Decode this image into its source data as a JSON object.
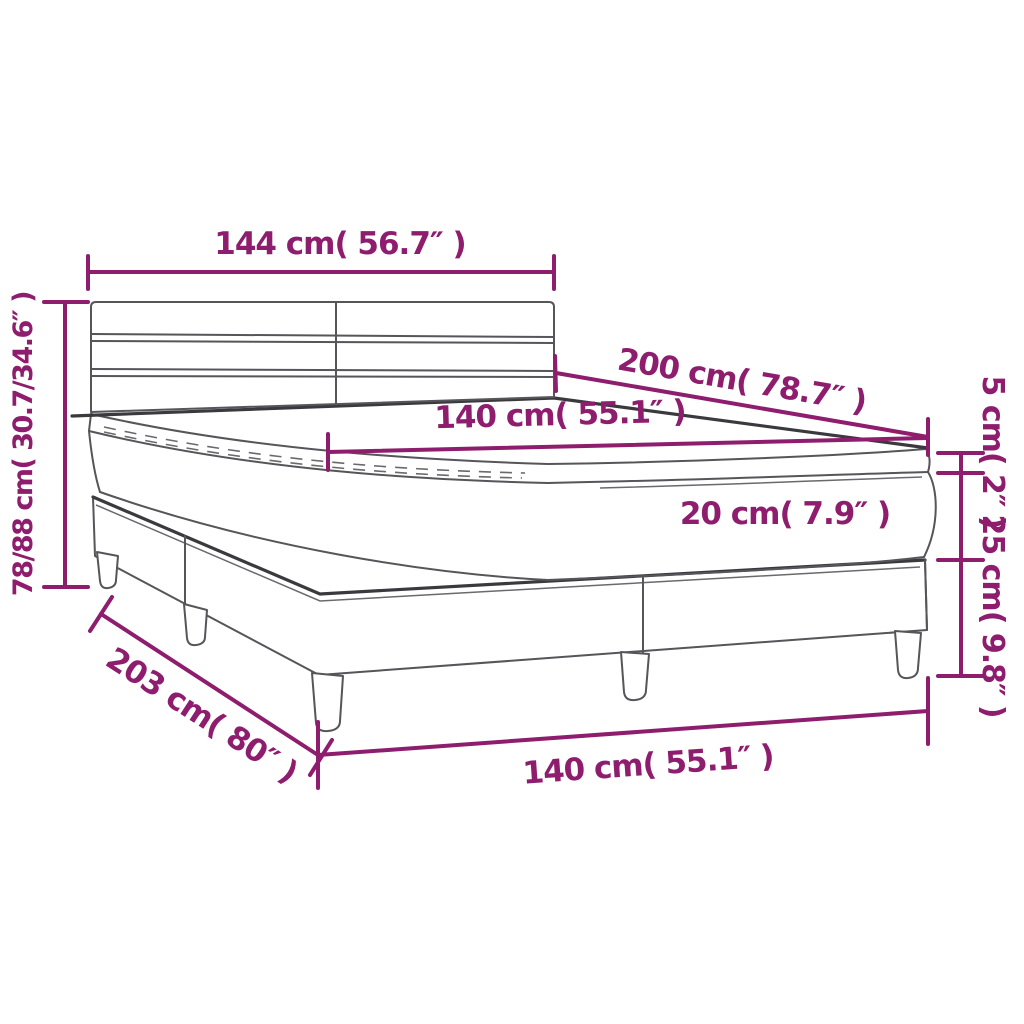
{
  "diagram": {
    "kind": "bed-dimension-diagram",
    "colors": {
      "dimension_accent": "#8e1d6e",
      "outline_gray": "#55555a",
      "outline_dark": "#3a3a3e",
      "background": "#ffffff"
    },
    "annotations": {
      "headboard_width": "144 cm( 56.7″ )",
      "total_height_range": "78/88 cm( 30.7/34.6″ )",
      "length_top": "200 cm( 78.7″ )",
      "mattress_width_top": "140 cm( 55.1″ )",
      "topper_thickness": "5 cm( 2″ )",
      "mattress_thickness": "20 cm( 7.9″ )",
      "base_height": "25 cm( 9.8″ )",
      "length_bottom": "203 cm( 80″ )",
      "mattress_width_bottom": "140 cm( 55.1″ )"
    }
  }
}
